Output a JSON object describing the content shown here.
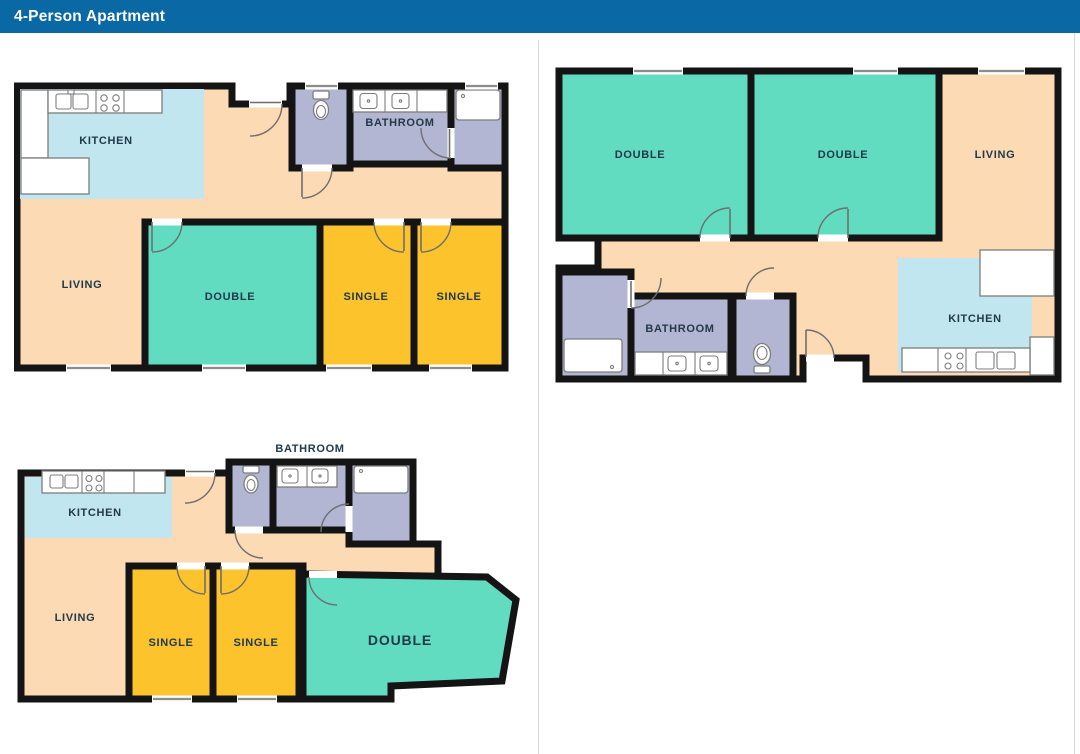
{
  "header": {
    "title": "4-Person Apartment"
  },
  "colors": {
    "header_bg": "#0a68a4",
    "wall": "#141414",
    "room_double": "#62dcc0",
    "room_single": "#fcc32d",
    "room_living": "#fcdab4",
    "room_kitchen": "#c2e6f0",
    "room_bath": "#b3b6d2",
    "label": "#21394a",
    "fixture_stroke": "#7d7d7d",
    "door_stroke": "#6e6e6e",
    "window_line": "#8c8c8c",
    "divider": "#d9d9d9"
  },
  "floor_plans": [
    {
      "position": "top-left",
      "rooms": [
        {
          "label": "KITCHEN"
        },
        {
          "label": "BATHROOM"
        },
        {
          "label": "LIVING"
        },
        {
          "label": "DOUBLE"
        },
        {
          "label": "SINGLE"
        },
        {
          "label": "SINGLE"
        }
      ],
      "fixtures": [
        "kitchen-sink-icon",
        "stove-icon",
        "counter-icon",
        "toilet-icon",
        "bathroom-sink-icon",
        "shower-tray-icon"
      ]
    },
    {
      "position": "top-right",
      "rooms": [
        {
          "label": "DOUBLE"
        },
        {
          "label": "DOUBLE"
        },
        {
          "label": "LIVING"
        },
        {
          "label": "BATHROOM"
        },
        {
          "label": "KITCHEN"
        }
      ],
      "fixtures": [
        "shower-tray-icon",
        "bathroom-sink-icon",
        "toilet-icon",
        "stove-icon",
        "kitchen-sink-icon",
        "counter-icon"
      ]
    },
    {
      "position": "bottom-left",
      "rooms": [
        {
          "label": "BATHROOM"
        },
        {
          "label": "KITCHEN"
        },
        {
          "label": "LIVING"
        },
        {
          "label": "SINGLE"
        },
        {
          "label": "SINGLE"
        },
        {
          "label": "DOUBLE"
        }
      ],
      "fixtures": [
        "kitchen-sink-icon",
        "stove-icon",
        "toilet-icon",
        "bathroom-sink-icon",
        "shower-tray-icon"
      ]
    }
  ]
}
